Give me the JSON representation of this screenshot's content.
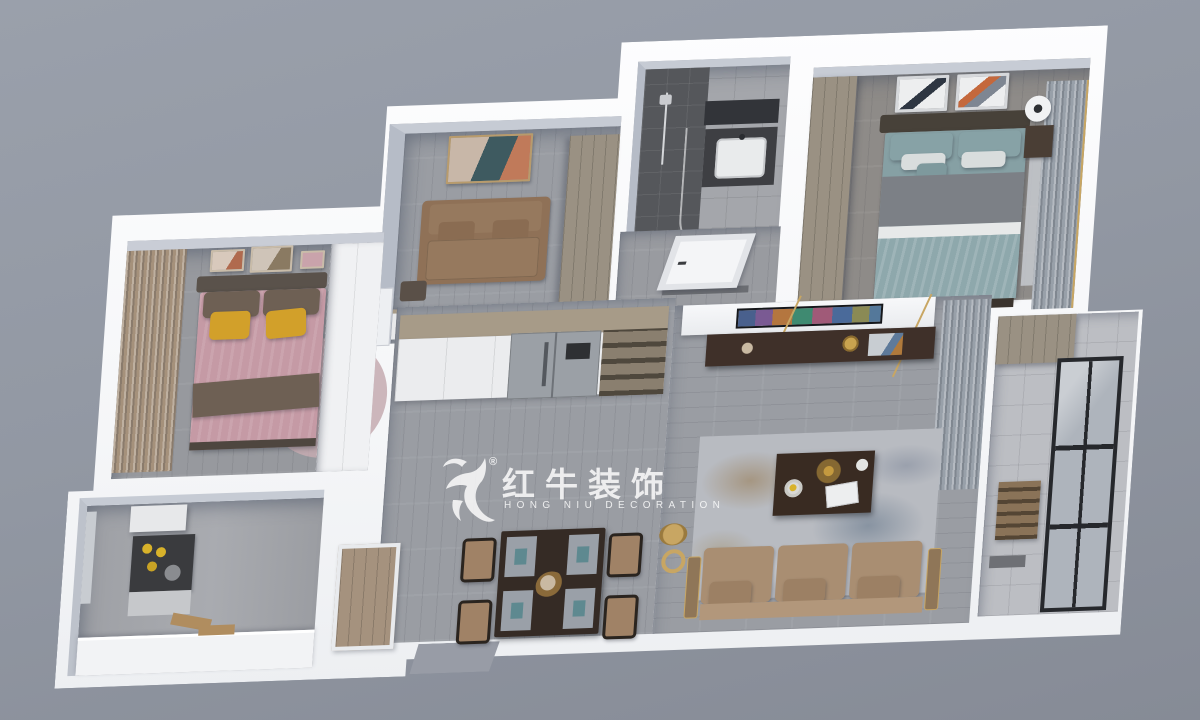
{
  "watermark": {
    "registered": "®",
    "brand_cn": "红牛装饰",
    "brand_en": "HONG NIU DECORATION"
  },
  "scene": {
    "description": "top-down 3D dollhouse render of a three-bedroom apartment",
    "background": "#9298A3",
    "wall": "#FAFBFC",
    "wall_face": "#C3C8D2"
  },
  "palette": {
    "floor_wood": "#9A9DA3",
    "floor_wood_dark": "#8E8B88",
    "floor_hall": "#999BA0",
    "floor_pink_room": "#97999E",
    "tile_gray": "#A4A6AB",
    "tile_shower": "#55575B",
    "tile_balcony": "#BCBEC3",
    "sofa_tan": "#A98E72",
    "sofa_seat": "#B2977B",
    "sofa_study": "#8F7157",
    "bed_teal": "#8EA8AC",
    "blanket_gray": "#7C8086",
    "bed_pink": "#C59AA5",
    "pillow_brown": "#6E6054",
    "pillow_yellow": "#D2A02A",
    "pillow_teal": "#87A2A6",
    "headboard_dark": "#474139",
    "wood_cabinet": "#9A9183",
    "wardrobe_white": "#F0F1F3",
    "cabinet_white": "#EBECEE",
    "counter_wood": "#A79B88",
    "counter_white": "#F2F3F5",
    "fridge_gray": "#9BA0A6",
    "shelf_wood": "#8A7F6F",
    "table_dark": "#352B25",
    "console_dark": "#3F3029",
    "coffee_table": "#392B22",
    "chair_tan": "#A08266",
    "curtain_gray": "#98A0A9",
    "curtain_brown": "#A5917B",
    "frame_black": "#26282C",
    "glass": "#AEB4BC",
    "brass": "#C8A663",
    "rug_pink": "#C4AAB0",
    "rug_living": "#B8BBC1",
    "door_wood": "#A5927E",
    "door_white": "#F4F5F7",
    "stove_dark": "#3A3B3E",
    "hood_white": "#E7E8EA",
    "mat_gray": "#9AA0A8",
    "napkin_teal": "#5E8990",
    "nightstand": "#4A3E35",
    "crate_wood": "#8A7358"
  },
  "rooms": {
    "study": {
      "label": "study lounge"
    },
    "bathroom": {
      "label": "bathroom"
    },
    "master_bedroom": {
      "label": "master bedroom"
    },
    "second_bedroom": {
      "label": "second bedroom (pink)"
    },
    "kitchen": {
      "label": "kitchen"
    },
    "dining": {
      "label": "dining area"
    },
    "living": {
      "label": "living room"
    },
    "balcony": {
      "label": "balcony"
    },
    "hall": {
      "label": "entry hall"
    }
  }
}
